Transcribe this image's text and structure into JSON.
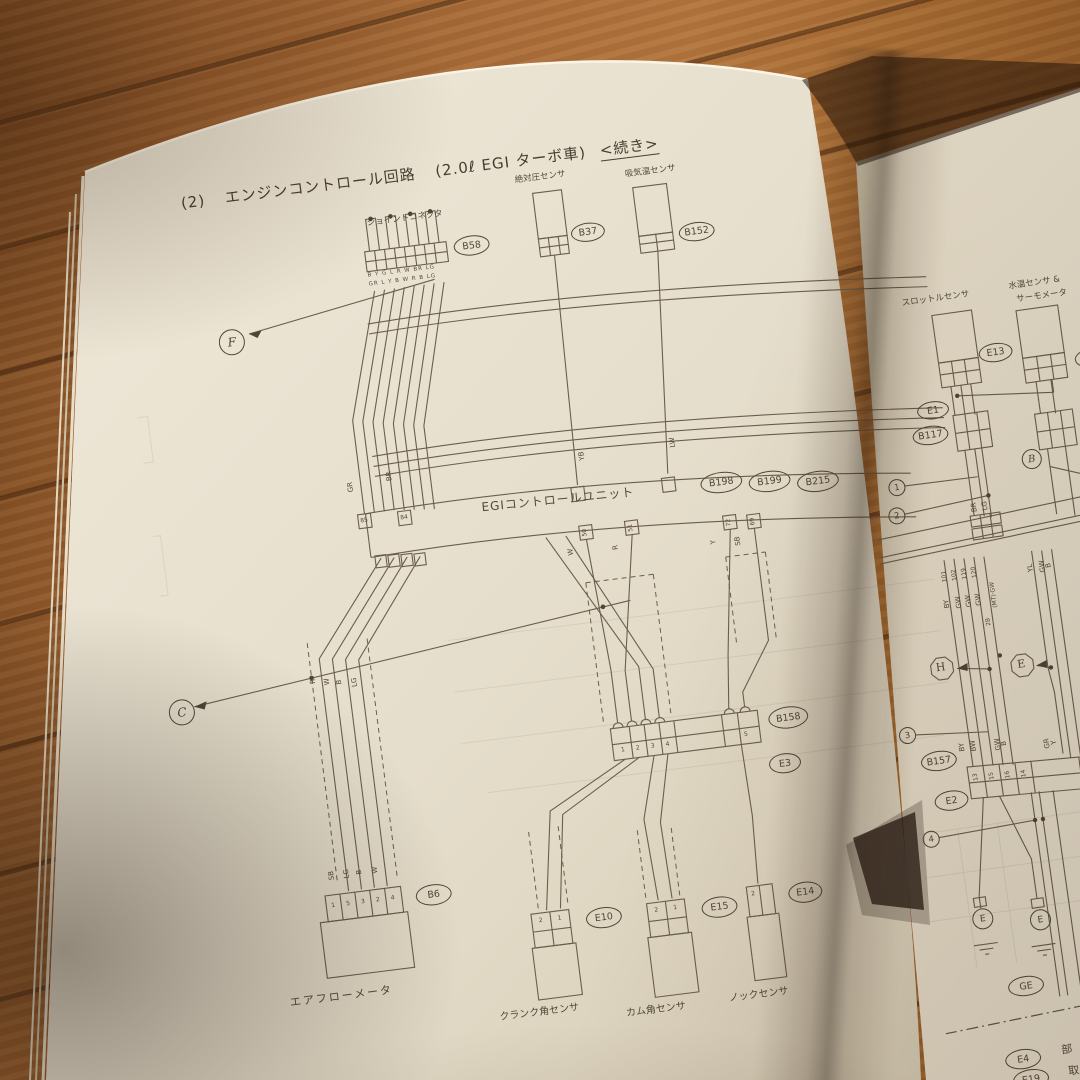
{
  "title": {
    "no": "(2)",
    "text": "エンジンコントロール回路",
    "variant": "(2.0ℓ EGI ターボ車)",
    "cont": "<続き>"
  },
  "left": {
    "labels": {
      "joint": "ジョイントコネクタ",
      "abs": "絶対圧センサ",
      "intake": "吸気温センサ",
      "ecu": "EGIコントロールユニット",
      "airflow": "エアフローメータ",
      "crank": "クランク角センサ",
      "cam": "カム角センサ",
      "knock": "ノックセンサ"
    },
    "refs": {
      "f": "F",
      "c": "C"
    },
    "conn": {
      "b58": "B58",
      "b37": "B37",
      "b152": "B152",
      "b198": "B198",
      "b199": "B199",
      "b215": "B215",
      "b158": "B158",
      "e3": "E3",
      "b6": "B6",
      "e10": "E10",
      "e15": "E15",
      "e14": "E14"
    },
    "wire": {
      "gr": "GR",
      "br": "BR",
      "yb": "YB",
      "lw": "LW",
      "w": "W",
      "n50": "50",
      "r": "R",
      "n51": "51",
      "y": "Y",
      "n72": "72",
      "sb": "SB",
      "n69": "69",
      "n85": "85",
      "n84": "84",
      "bund1": "R",
      "bund2": "W",
      "bund3": "B",
      "bund4": "LG",
      "af1": "SB",
      "af2": "LG",
      "af3": "B",
      "af4": "W",
      "b58a": "B Y G L R W BR LG",
      "b58b": "GR L Y B W R B LG"
    },
    "pins": {
      "b6": [
        "1",
        "5",
        "3",
        "2",
        "4"
      ],
      "e10a": "2",
      "e10b": "1",
      "e15a": "2",
      "e15b": "1",
      "e14": "2",
      "b158": [
        "1",
        "2",
        "3",
        "4"
      ],
      "b158r": "5"
    }
  },
  "right": {
    "labels": {
      "throttle": "スロットルセンサ",
      "water1": "水温センサ &",
      "water2": "サーモメータ"
    },
    "conn": {
      "e13": "E13",
      "e1": "E1",
      "b117": "B117",
      "b157": "B157",
      "e2": "E2",
      "ge": "GE",
      "e4": "E4",
      "e19": "E19"
    },
    "refs": {
      "b": "B",
      "h": "H",
      "e": "E",
      "n1": "1",
      "n2": "2",
      "n3": "3",
      "n4": "4",
      "gnd1": "E",
      "gnd2": "E"
    },
    "wire": {
      "br": "BR",
      "lg": "LG",
      "n101": "101",
      "n102": "102",
      "n119": "119",
      "n120": "120",
      "by": "BY",
      "gw1": "GW",
      "gw2": "GW",
      "gw3": "GW",
      "mt": "(MT)·GW",
      "n2b": "2B",
      "yl": "YL",
      "gw4": "GW",
      "b": "B",
      "by2": "BY",
      "bw": "BW",
      "gw5": "GW",
      "b2": "B",
      "gr": "GR",
      "y": "Y"
    },
    "pins": {
      "p13": "13",
      "p15": "15",
      "p16": "16",
      "p14": "14",
      "p4": "4"
    },
    "partial": {
      "k1": "部",
      "k2": "取"
    }
  }
}
